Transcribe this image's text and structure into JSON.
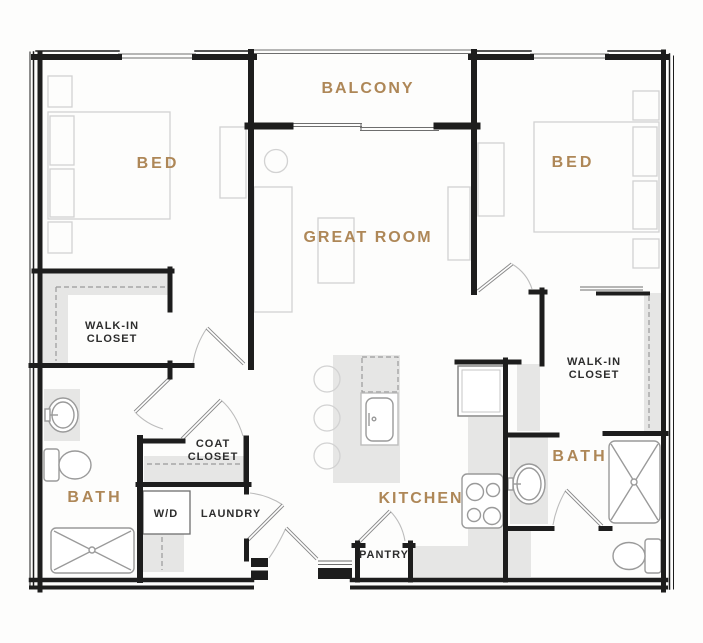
{
  "floor_plan": {
    "title": "Two bedroom two bath apartment floor plan",
    "rooms": {
      "balcony": {
        "label": "BALCONY"
      },
      "bed_left": {
        "label": "BED"
      },
      "bed_right": {
        "label": "BED"
      },
      "great_room": {
        "label": "GREAT ROOM"
      },
      "kitchen": {
        "label": "KITCHEN"
      },
      "bath_left": {
        "label": "BATH"
      },
      "bath_right": {
        "label": "BATH"
      },
      "walk_in_closet_left": {
        "line1": "WALK-IN",
        "line2": "CLOSET"
      },
      "walk_in_closet_right": {
        "line1": "WALK-IN",
        "line2": "CLOSET"
      },
      "coat_closet": {
        "line1": "COAT",
        "line2": "CLOSET"
      },
      "laundry": {
        "label": "LAUNDRY"
      },
      "washer_dryer": {
        "label": "W/D"
      },
      "pantry": {
        "label": "PANTRY"
      }
    },
    "colors": {
      "room_label": "#ae8757",
      "utility_label": "#2d2d2d",
      "wall": "#1d1d1d",
      "fixture": "#9a9a9a",
      "furniture": "#d2d2d2",
      "shading": "#e6e6e5",
      "background": "#fdfdfc"
    }
  }
}
